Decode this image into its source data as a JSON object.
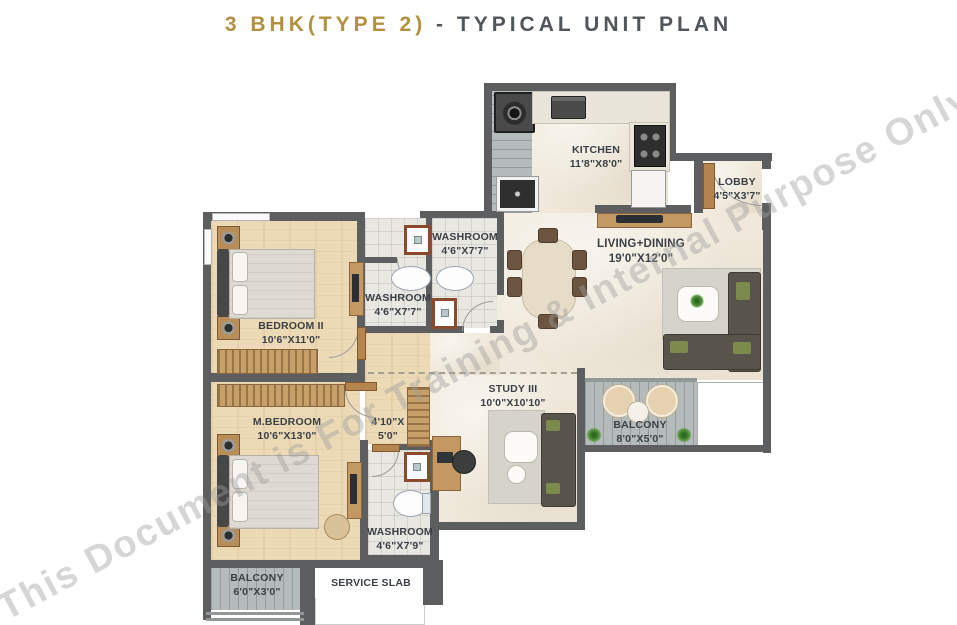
{
  "title": {
    "accent": "3 BHK(TYPE 2)",
    "rest": " - TYPICAL UNIT PLAN"
  },
  "watermark": "This Document is For Training & Internal Purpose Only",
  "colors": {
    "title_accent_gold": "#b3903f",
    "title_gray": "#51565b",
    "wall_gray": "#5d5e5f",
    "floor_wood_tan": "#ecd9b6",
    "floor_marble_cream": "#f0e9db",
    "floor_tile_gray": "#e9e7e2",
    "balcony_deck_gray": "#b5baba",
    "furniture_brown": "#c39862",
    "label_text": "#3b4046"
  },
  "rooms": {
    "kitchen": {
      "name": "KITCHEN",
      "dims": "11'8\"X8'0\""
    },
    "lobby": {
      "name": "LOBBY",
      "dims": "4'5\"X3'7\""
    },
    "living_dining": {
      "name": "LIVING+DINING",
      "dims": "19'0\"X12'0\""
    },
    "washroom_top": {
      "name": "WASHROOM",
      "dims": "4'6\"X7'7\""
    },
    "washroom_mid": {
      "name": "WASHROOM",
      "dims": "4'6\"X7'7\""
    },
    "bedroom_ii": {
      "name": "BEDROOM II",
      "dims": "10'6\"X11'0\""
    },
    "m_bedroom": {
      "name": "M.BEDROOM",
      "dims": "10'6\"X13'0\""
    },
    "passage": {
      "name": "4'10\"X",
      "dims": "5'0\""
    },
    "study": {
      "name": "STUDY III",
      "dims": "10'0\"X10'10\""
    },
    "balcony_living": {
      "name": "BALCONY",
      "dims": "8'0\"X5'0\""
    },
    "washroom_master": {
      "name": "WASHROOM",
      "dims": "4'6\"X7'9\""
    },
    "balcony_bedroom": {
      "name": "BALCONY",
      "dims": "6'0\"X3'0\""
    },
    "service_slab": {
      "name": "SERVICE SLAB"
    }
  }
}
